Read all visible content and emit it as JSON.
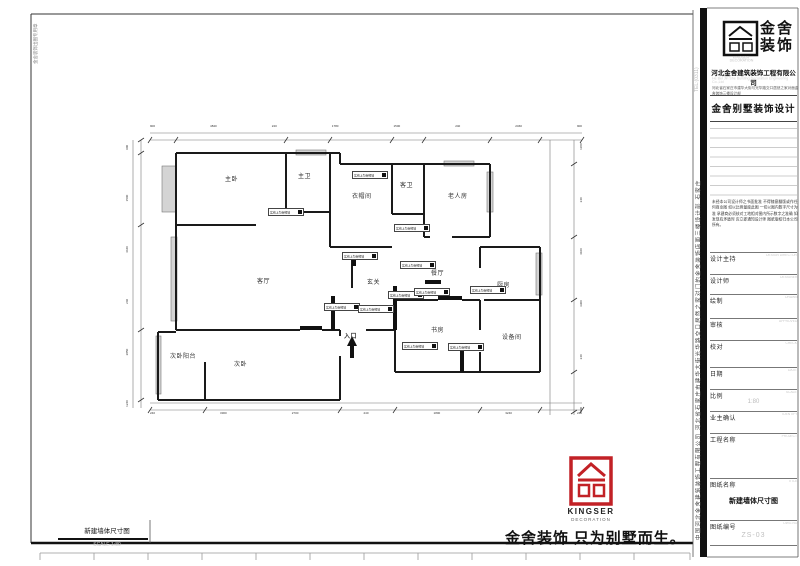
{
  "plan": {
    "rooms": {
      "master_bedroom": "主卧",
      "master_bath": "主卫",
      "cloakroom": "衣帽间",
      "guest_bath": "客卫",
      "elder_room": "老人房",
      "living_room": "客厅",
      "foyer": "玄关",
      "dining_room": "餐厅",
      "kitchen": "厨房",
      "study": "书房",
      "equipment_room": "设备间",
      "second_bedroom": "次卧",
      "second_balcony": "次卧阳台",
      "entrance": "入口"
    },
    "wall_note": "实线上为新砌墙",
    "dims": {
      "top": [
        "900",
        "4840",
        "240",
        "1780",
        "1500",
        "240",
        "2460",
        "900"
      ],
      "bottom": [
        "240",
        "3300",
        "2700",
        "240",
        "1800",
        "3240",
        "240"
      ],
      "left": [
        "900",
        "1500",
        "4440",
        "240",
        "2850",
        "1240"
      ],
      "right": [
        "1180",
        "240",
        "4100",
        "3300",
        "240",
        "900"
      ]
    }
  },
  "titleblock": {
    "brand_cn_1": "金舍",
    "brand_cn_2": "装饰",
    "brand_en": "KINGSER",
    "brand_en_sub": "DECORATION",
    "company": "河北金舍建筑装饰工程有限公司",
    "company_en": "He Bei Jin She Building Decoration Engineering Co.,Ltd",
    "address": "河北省石家庄市建华大街与光华路交口居然之家对面金舍装饰三楼设计部",
    "dept_title": "金舍别墅装饰设计",
    "disclaimer": "未经本公司设计师之书面批准 不得随意翻版或作任何商业图 如以比例量度此图 一切以图内数字尺寸为准 承建商必须核对工地相对图内所示数字之准确 如发现有矛盾时 应立即通知设计师 图纸版权归本公司所有。",
    "rows": [
      {
        "label": "设计主持",
        "en": "DESIGN DIRECTOR"
      },
      {
        "label": "设计师",
        "en": "DESIGNER"
      },
      {
        "label": "绘制",
        "en": "DRAWN"
      },
      {
        "label": "审核",
        "en": "APPROVED"
      },
      {
        "label": "校对",
        "en": "CHECK"
      },
      {
        "label": "日期",
        "en": "DATE"
      },
      {
        "label": "比例",
        "en": "SCALE",
        "value": "1:80"
      },
      {
        "label": "业主确认",
        "en": "IDENTIFY"
      },
      {
        "label": "工程名称",
        "en": "PROJECT"
      },
      {
        "label": "图纸名称",
        "en": "TITLE",
        "value": "新建墙体尺寸图"
      },
      {
        "label": "图纸编号",
        "en": "DWG.NO",
        "value": "ZS-03"
      }
    ],
    "side_text": "中国河北金舍建筑装饰工程有限公司 河北省石家庄市建华大街光华路交口居然之家对门的金舍装饰店面三楼设计部 石家庄",
    "side_tel": "TEL:(0311)"
  },
  "footer": {
    "slogan": "金舍装饰 只为别墅而生。",
    "logo_en": "KINGSER",
    "logo_sub": "DECORATION",
    "drawing_label": "新建墙体尺寸图",
    "drawing_scale": "SCALE 1:80"
  },
  "stamp": "金舍装饰出图专用章"
}
